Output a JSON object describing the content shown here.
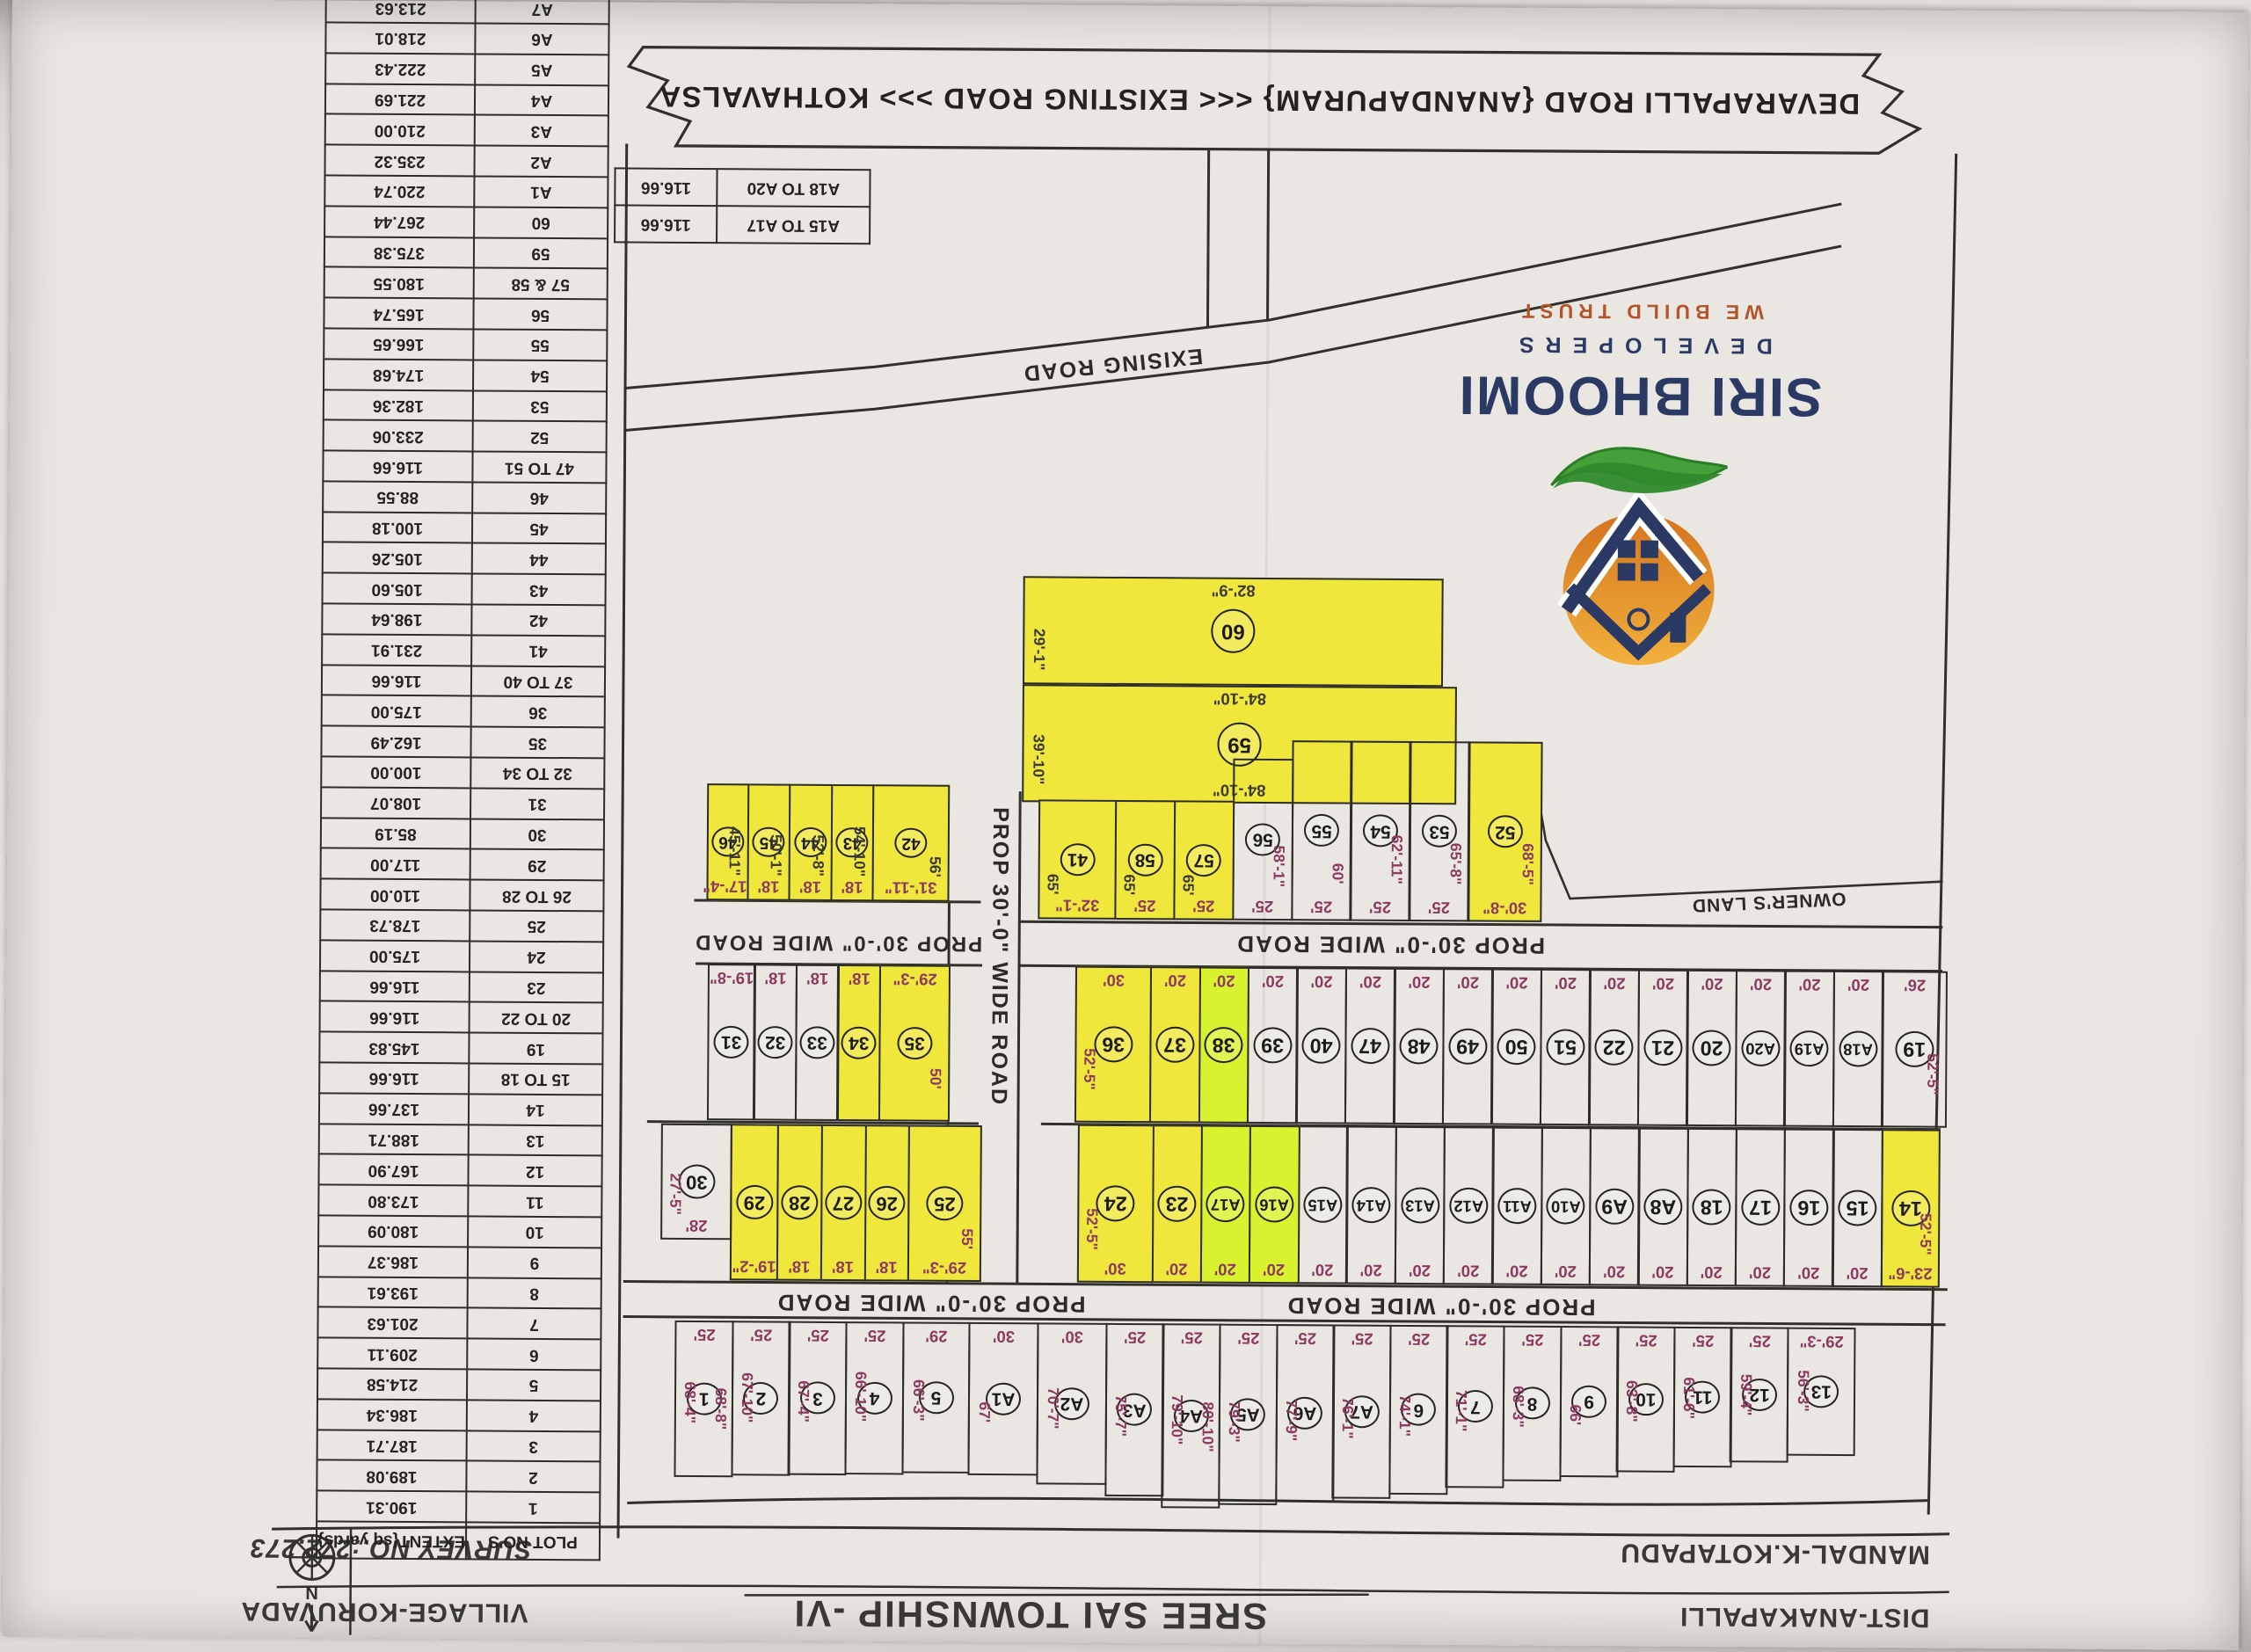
{
  "header": {
    "district": "DIST-ANAKAPALLI",
    "mandal": "MANDAL-K.KOTAPADU",
    "title": "SREE SAI TOWNSHIP  -VI",
    "survey": "SURVEY NO.:272,273",
    "village": "VILLAGE-KORUVADA",
    "compass_letter": "N"
  },
  "logo": {
    "name": "SIRI BHOOMI",
    "sub": "DEVELOPERS",
    "tagline": "WE BUILD TRUST"
  },
  "banner": {
    "text": "DEVARAPALLI ROAD {ANANDAPURAM} <<< EXISTING ROAD >>> KOTHAVALSA"
  },
  "roads": {
    "prop": "PROP 30'-0\" WIDE ROAD",
    "exising": "EXISING ROAD",
    "owners": "OWNER'S LAND"
  },
  "ref": {
    "rows": [
      [
        "A15 TO A17",
        "116.66"
      ],
      [
        "A18 TO A20",
        "116.66"
      ]
    ]
  },
  "table": {
    "headers": [
      "PLOT NO'S",
      "EXTENT{sq yards}"
    ],
    "rows": [
      [
        "1",
        "190.31"
      ],
      [
        "2",
        "189.08"
      ],
      [
        "3",
        "187.71"
      ],
      [
        "4",
        "186.34"
      ],
      [
        "5",
        "214.58"
      ],
      [
        "6",
        "209.11"
      ],
      [
        "7",
        "201.63"
      ],
      [
        "8",
        "193.61"
      ],
      [
        "9",
        "186.37"
      ],
      [
        "10",
        "180.09"
      ],
      [
        "11",
        "173.80"
      ],
      [
        "12",
        "167.90"
      ],
      [
        "13",
        "188.71"
      ],
      [
        "14",
        "137.66"
      ],
      [
        "15 TO 18",
        "116.66"
      ],
      [
        "19",
        "145.83"
      ],
      [
        "20 TO 22",
        "116.66"
      ],
      [
        "23",
        "116.66"
      ],
      [
        "24",
        "175.00"
      ],
      [
        "25",
        "178.73"
      ],
      [
        "26 TO 28",
        "110.00"
      ],
      [
        "29",
        "117.00"
      ],
      [
        "30",
        "85.19"
      ],
      [
        "31",
        "108.07"
      ],
      [
        "32 TO 34",
        "100.00"
      ],
      [
        "35",
        "162.49"
      ],
      [
        "36",
        "175.00"
      ],
      [
        "37 TO 40",
        "116.66"
      ],
      [
        "41",
        "231.91"
      ],
      [
        "42",
        "198.64"
      ],
      [
        "43",
        "105.60"
      ],
      [
        "44",
        "105.26"
      ],
      [
        "45",
        "100.18"
      ],
      [
        "46",
        "88.55"
      ],
      [
        "47 TO 51",
        "116.66"
      ],
      [
        "52",
        "233.06"
      ],
      [
        "53",
        "182.36"
      ],
      [
        "54",
        "174.68"
      ],
      [
        "55",
        "166.65"
      ],
      [
        "56",
        "165.74"
      ],
      [
        "57 & 58",
        "180.55"
      ],
      [
        "59",
        "375.38"
      ],
      [
        "60",
        "267.44"
      ],
      [
        "A1",
        "220.74"
      ],
      [
        "A2",
        "235.32"
      ],
      [
        "A3",
        "210.00"
      ],
      [
        "A4",
        "221.69"
      ],
      [
        "A5",
        "222.43"
      ],
      [
        "A6",
        "218.01"
      ],
      [
        "A7",
        "213.63"
      ],
      [
        "A8 TO A14",
        "116.66"
      ]
    ]
  },
  "plots": {
    "strip": [
      {
        "n": "13",
        "w": "29'-3\"",
        "s": "56'-3\""
      },
      {
        "n": "12",
        "w": "25'",
        "s": "59'-4\""
      },
      {
        "n": "11",
        "w": "25'",
        "s": "61'-6\""
      },
      {
        "n": "10",
        "w": "25'",
        "s": "63'-8\""
      },
      {
        "n": "9",
        "w": "25'",
        "s": "66'"
      },
      {
        "n": "8",
        "w": "25'",
        "s": "68'-3\""
      },
      {
        "n": "7",
        "w": "25'",
        "s": "71'-1\""
      },
      {
        "n": "6",
        "w": "25'",
        "s": "74'-1\""
      },
      {
        "n": "A7",
        "w": "25'",
        "s": "76'-1\""
      },
      {
        "n": "A6",
        "w": "25'",
        "s": "77'-9\""
      },
      {
        "n": "A5",
        "w": "25'",
        "s": "79'-3\""
      },
      {
        "n": "A4",
        "w": "25'",
        "s": "79'-10\"",
        "s2": "80'-10\""
      },
      {
        "n": "A3",
        "w": "25'",
        "s": "75'-7\""
      },
      {
        "n": "A2",
        "w": "30'",
        "s": "70'-7\""
      },
      {
        "n": "A1",
        "w": "30'",
        "s": "67'"
      },
      {
        "n": "5",
        "w": "29'",
        "s": "66'-3\""
      },
      {
        "n": "4",
        "w": "25'",
        "s": "66'-10\""
      },
      {
        "n": "3",
        "w": "25'",
        "s": "67'-4\""
      },
      {
        "n": "2",
        "w": "25'",
        "s": "67'-10\""
      },
      {
        "n": "1",
        "w": "25'",
        "s": "68'-4\"",
        "s2": "68'-8\""
      }
    ],
    "midUpper": [
      {
        "n": "14",
        "w": "23'-6\"",
        "s": "52'-5\"",
        "hl": 1,
        "spos": "l"
      },
      {
        "n": "15",
        "w": "20'"
      },
      {
        "n": "16",
        "w": "20'"
      },
      {
        "n": "17",
        "w": "20'"
      },
      {
        "n": "18",
        "w": "20'"
      },
      {
        "n": "A8",
        "w": "20'"
      },
      {
        "n": "A9",
        "w": "20'"
      },
      {
        "n": "A10",
        "w": "20'"
      },
      {
        "n": "A11",
        "w": "20'"
      },
      {
        "n": "A12",
        "w": "20'"
      },
      {
        "n": "A13",
        "w": "20'"
      },
      {
        "n": "A14",
        "w": "20'"
      },
      {
        "n": "A15",
        "w": "20'"
      },
      {
        "n": "A16",
        "w": "20'",
        "hl": 2
      },
      {
        "n": "A17",
        "w": "20'",
        "hl": 2
      },
      {
        "n": "23",
        "w": "20'",
        "hl": 1
      },
      {
        "n": "24",
        "w": "30'",
        "s": "52'-5\"",
        "hl": 1,
        "spos": "r"
      }
    ],
    "midLower": [
      {
        "n": "19",
        "w": "26'",
        "s": "52'-5\"",
        "spos": "l"
      },
      {
        "n": "A18",
        "w": "20'"
      },
      {
        "n": "A19",
        "w": "20'"
      },
      {
        "n": "A20",
        "w": "20'"
      },
      {
        "n": "20",
        "w": "20'"
      },
      {
        "n": "21",
        "w": "20'"
      },
      {
        "n": "22",
        "w": "20'"
      },
      {
        "n": "51",
        "w": "20'"
      },
      {
        "n": "50",
        "w": "20'"
      },
      {
        "n": "49",
        "w": "20'"
      },
      {
        "n": "48",
        "w": "20'"
      },
      {
        "n": "47",
        "w": "20'"
      },
      {
        "n": "40",
        "w": "20'"
      },
      {
        "n": "39",
        "w": "20'"
      },
      {
        "n": "38",
        "w": "20'",
        "hl": 2
      },
      {
        "n": "37",
        "w": "20'",
        "hl": 1
      },
      {
        "n": "36",
        "w": "30'",
        "s": "52'-5\"",
        "hl": 1,
        "spos": "r"
      }
    ],
    "row2530": [
      {
        "n": "25",
        "w": "29'-3\"",
        "s": "55'",
        "hl": 1,
        "spos": "l"
      },
      {
        "n": "26",
        "w": "18'",
        "hl": 1
      },
      {
        "n": "27",
        "w": "18'",
        "hl": 1
      },
      {
        "n": "28",
        "w": "18'",
        "hl": 1
      },
      {
        "n": "29",
        "w": "19'-2\"",
        "hl": 1
      },
      {
        "n": "30",
        "w": "28'",
        "s": "27'-5\"",
        "spos": "r"
      }
    ],
    "row3135": [
      {
        "n": "35",
        "w": "29'-3\"",
        "s": "50'",
        "hl": 1,
        "spos": "l"
      },
      {
        "n": "34",
        "w": "18'",
        "hl": 1
      },
      {
        "n": "33",
        "w": "18'"
      },
      {
        "n": "32",
        "w": "18'"
      },
      {
        "n": "31",
        "w": "19'-8\""
      }
    ],
    "row5241": [
      {
        "n": "52",
        "w": "30'-8\"",
        "s": "68'-5\"",
        "hl": 1,
        "spos": "l"
      },
      {
        "n": "53",
        "w": "25'",
        "s": "65'-8\"",
        "spos": "l"
      },
      {
        "n": "54",
        "w": "25'",
        "s": "62'-11\"",
        "spos": "l"
      },
      {
        "n": "55",
        "w": "25'",
        "s": "60'",
        "spos": "l"
      },
      {
        "n": "56",
        "w": "25'",
        "s": "58'-1\"",
        "spos": "l"
      },
      {
        "n": "57",
        "w": "25'",
        "s": "65'",
        "hl": 1,
        "sk": 1,
        "spos": "r"
      },
      {
        "n": "58",
        "w": "25'",
        "s": "65'",
        "hl": 1,
        "sk": 1,
        "spos": "r"
      },
      {
        "n": "41",
        "w": "32'-1\"",
        "s": "65'",
        "hl": 1,
        "sk": 1,
        "spos": "r"
      }
    ],
    "row4246": [
      {
        "n": "42",
        "w": "31'-11\"",
        "s": "56'",
        "hl": 1,
        "sk": 1,
        "spos": "l"
      },
      {
        "n": "43",
        "w": "18'",
        "s": "54'-10\"",
        "hl": 1,
        "sk": 1,
        "spos": "l"
      },
      {
        "n": "44",
        "w": "18'",
        "s": "52'-8\"",
        "hl": 1,
        "sk": 1,
        "spos": "l"
      },
      {
        "n": "45",
        "w": "18'",
        "s": "50'-1\"",
        "hl": 1,
        "sk": 1,
        "spos": "l"
      },
      {
        "n": "46",
        "w": "17'-4\"",
        "s": "45'-11\"",
        "hl": 1,
        "sk": 1,
        "spos": "l"
      }
    ],
    "p59": {
      "n": "59",
      "top": "84'-10\"",
      "bottom": "84'-10\"",
      "s": "39'-10\""
    },
    "p60": {
      "n": "60",
      "bottom": "82'-9\"",
      "s": "29'-1\""
    }
  }
}
